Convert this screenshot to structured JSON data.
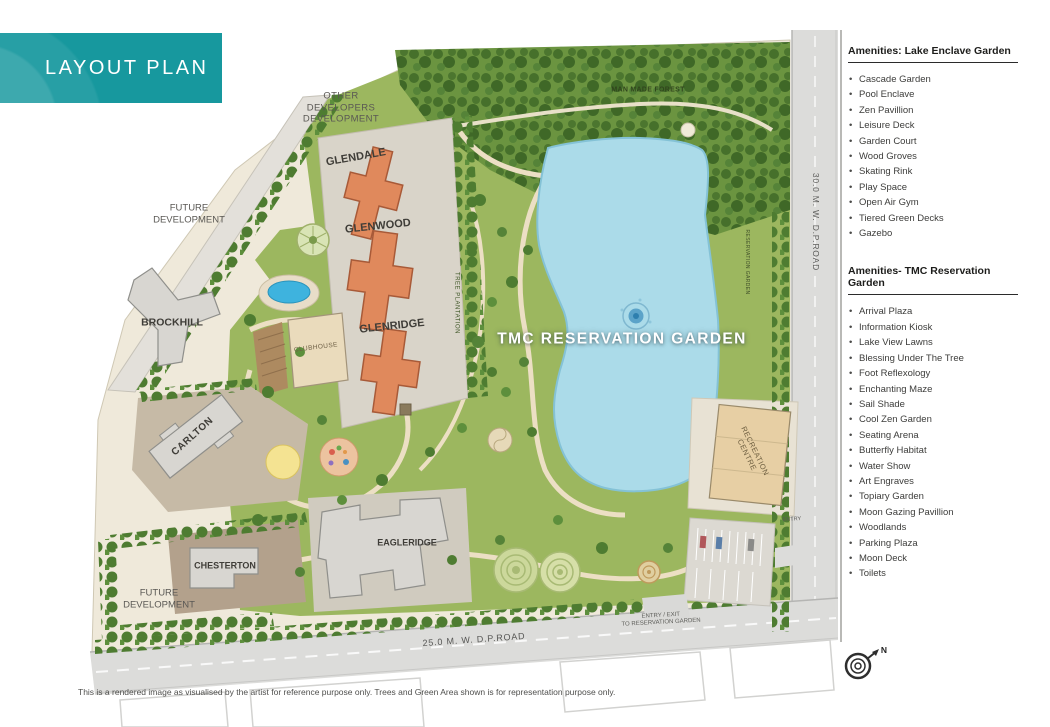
{
  "title": "LAYOUT PLAN",
  "map": {
    "labels": {
      "other_developers": "OTHER\nDEVELOPERS\nDEVELOPMENT",
      "glendale": "GLENDALE",
      "man_made_forest": "MAN MADE FOREST",
      "future_development_left": "FUTURE\nDEVELOPMENT",
      "brockhill": "BROCKHILL",
      "glenwood": "GLENWOOD",
      "glenridge": "GLENRIDGE",
      "tree_plantation": "TREE PLANTATION",
      "clubhouse": "CLUBHOUSE",
      "carlton": "CARLTON",
      "tmc_reservation_garden": "TMC RESERVATION GARDEN",
      "reservation_garden_small": "RESERVATION GARDEN",
      "road_30m": "30.0 M. W. D.P.ROAD",
      "recreation_centre": "RECREATION\nCENTRE",
      "chesterton": "CHESTERTON",
      "eagleridge": "EAGLERIDGE",
      "future_development_bottom": "FUTURE\nDEVELOPMENT",
      "road_25m": "25.0 M. W. D.P.ROAD",
      "entry_exit": "ENTRY / EXIT\nTO RESERVATION GARDEN",
      "entry": "ENTRY",
      "compass_north": "N"
    }
  },
  "sidebar": {
    "sections": [
      {
        "header": "Amenities: Lake Enclave Garden",
        "items": [
          "Cascade Garden",
          "Pool Enclave",
          "Zen Pavillion",
          "Leisure Deck",
          "Garden Court",
          "Wood Groves",
          "Skating Rink",
          "Play Space",
          "Open Air Gym",
          "Tiered Green Decks",
          "Gazebo"
        ]
      },
      {
        "header": "Amenities- TMC Reservation Garden",
        "items": [
          "Arrival Plaza",
          "Information Kiosk",
          "Lake View Lawns",
          "Blessing Under The Tree",
          "Foot Reflexology",
          "Enchanting Maze",
          "Sail Shade",
          "Cool Zen Garden",
          "Seating Arena",
          "Butterfly Habitat",
          "Water Show",
          "Art Engraves",
          "Topiary Garden",
          "Moon Gazing Pavillion",
          "Woodlands",
          "Parking Plaza",
          "Moon Deck",
          "Toilets"
        ]
      }
    ]
  },
  "footer": {
    "disclaimer": "This is a rendered image as visualised by the artist for reference purpose only. Trees and Green Area shown is for representation purpose only."
  },
  "colors": {
    "accent_teal": "#17989e",
    "lake_blue": "#abdbe9",
    "building_orange": "#e0895c",
    "building_gray": "#d8d6d1",
    "forest_green": "#6b9440",
    "park_green": "#9cb75f",
    "road_gray": "#dcdcda"
  }
}
